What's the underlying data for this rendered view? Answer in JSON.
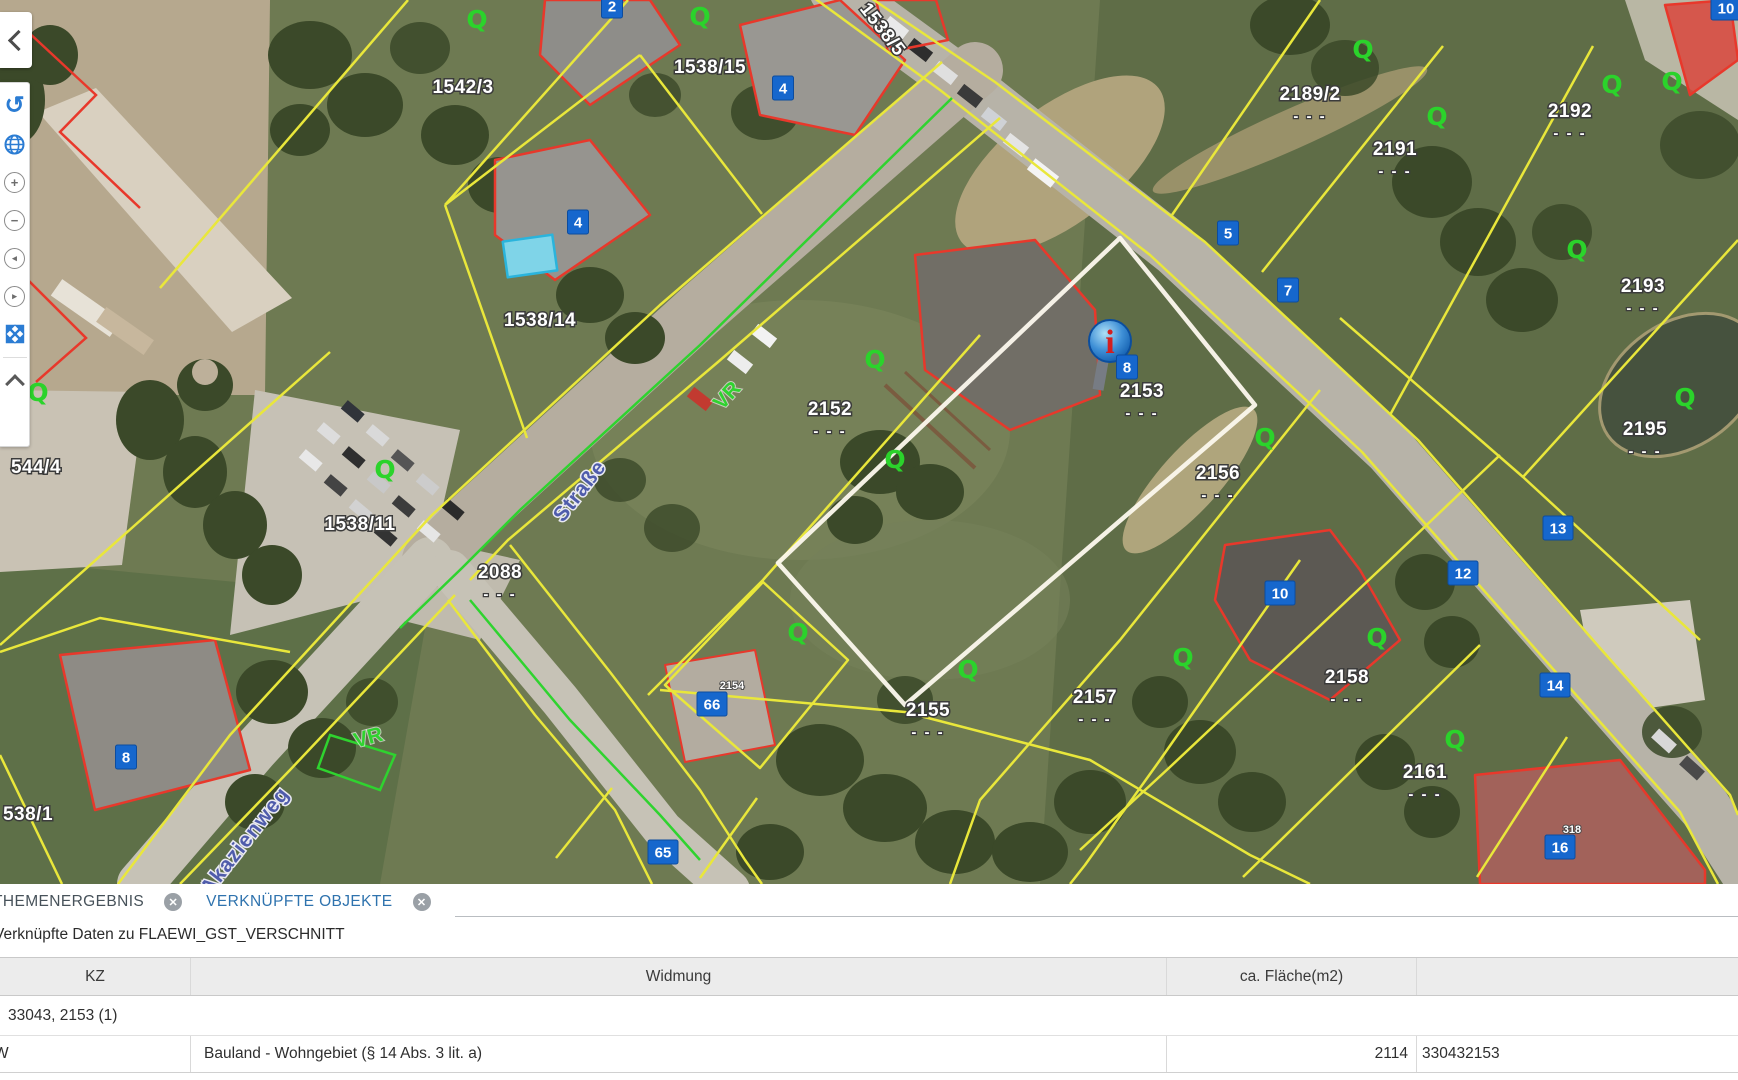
{
  "window": {
    "width": 1738,
    "height": 1080
  },
  "toolbar": {
    "icon_glyphs": {
      "undo": "↺",
      "zoom_in": "+",
      "zoom_out": "−",
      "pan_left": "◂",
      "pan_right": "▸"
    }
  },
  "map": {
    "colors": {
      "parcel_line_yellow": "#e9e73b",
      "building_red": "#e8382b",
      "overlay_green": "#2fd32f",
      "badge_blue": "#1667cd",
      "selection_white": "#fbf7ec",
      "street_blue": "#4f5cab"
    },
    "marker_label": "i",
    "dash_text": "- - -",
    "green_symbol": "Q",
    "parcel_labels": [
      {
        "text": "1542/3",
        "x": 463,
        "y": 93,
        "dashes": false
      },
      {
        "text": "1538/15",
        "x": 710,
        "y": 73,
        "dashes": false
      },
      {
        "text": "1538/5",
        "x": 878,
        "y": 33,
        "dashes": false,
        "rotate": 52
      },
      {
        "text": "1538/14",
        "x": 540,
        "y": 326,
        "dashes": false
      },
      {
        "text": "2189/2",
        "x": 1310,
        "y": 100,
        "dashes": true
      },
      {
        "text": "2191",
        "x": 1395,
        "y": 155,
        "dashes": true
      },
      {
        "text": "2192",
        "x": 1570,
        "y": 117,
        "dashes": true
      },
      {
        "text": "2193",
        "x": 1643,
        "y": 292,
        "dashes": true
      },
      {
        "text": "2195",
        "x": 1645,
        "y": 435,
        "dashes": true
      },
      {
        "text": "2152",
        "x": 830,
        "y": 415,
        "dashes": true
      },
      {
        "text": "2153",
        "x": 1142,
        "y": 397,
        "dashes": true
      },
      {
        "text": "2156",
        "x": 1218,
        "y": 479,
        "dashes": true
      },
      {
        "text": "2088",
        "x": 500,
        "y": 578,
        "dashes": true
      },
      {
        "text": "1538/11",
        "x": 360,
        "y": 530,
        "dashes": false
      },
      {
        "text": "544/4",
        "x": 36,
        "y": 473,
        "dashes": false
      },
      {
        "text": "2155",
        "x": 928,
        "y": 716,
        "dashes": true
      },
      {
        "text": "2157",
        "x": 1095,
        "y": 703,
        "dashes": true
      },
      {
        "text": "2158",
        "x": 1347,
        "y": 683,
        "dashes": true
      },
      {
        "text": "2161",
        "x": 1425,
        "y": 778,
        "dashes": true
      },
      {
        "text": "538/1",
        "x": 28,
        "y": 820,
        "dashes": false
      }
    ],
    "small_labels": [
      {
        "text": "2154",
        "x": 732,
        "y": 689
      },
      {
        "text": "318",
        "x": 1572,
        "y": 833
      }
    ],
    "street_labels": [
      {
        "text": "Straße",
        "x": 585,
        "y": 495,
        "rotate": -52
      },
      {
        "text": "Akazienweg",
        "x": 250,
        "y": 845,
        "rotate": -52
      }
    ],
    "vr_labels": [
      {
        "text": "VR",
        "x": 732,
        "y": 400,
        "rotate": -48
      },
      {
        "text": "VR",
        "x": 370,
        "y": 744,
        "rotate": -15
      }
    ],
    "green_symbols": [
      {
        "x": 477,
        "y": 28
      },
      {
        "x": 700,
        "y": 25
      },
      {
        "x": 1363,
        "y": 58
      },
      {
        "x": 1437,
        "y": 125
      },
      {
        "x": 1612,
        "y": 93
      },
      {
        "x": 1672,
        "y": 90
      },
      {
        "x": 1577,
        "y": 258
      },
      {
        "x": 1685,
        "y": 406
      },
      {
        "x": 875,
        "y": 368
      },
      {
        "x": 895,
        "y": 468
      },
      {
        "x": 798,
        "y": 641
      },
      {
        "x": 968,
        "y": 678
      },
      {
        "x": 38,
        "y": 401
      },
      {
        "x": 385,
        "y": 478
      },
      {
        "x": 1265,
        "y": 446
      },
      {
        "x": 1377,
        "y": 646
      },
      {
        "x": 1455,
        "y": 748
      },
      {
        "x": 1183,
        "y": 666
      }
    ],
    "badges": [
      {
        "text": "2",
        "x": 612,
        "y": 6
      },
      {
        "text": "4",
        "x": 783,
        "y": 88
      },
      {
        "text": "4",
        "x": 578,
        "y": 222
      },
      {
        "text": "5",
        "x": 1228,
        "y": 233
      },
      {
        "text": "7",
        "x": 1288,
        "y": 290
      },
      {
        "text": "8",
        "x": 1127,
        "y": 367
      },
      {
        "text": "10",
        "x": 1280,
        "y": 593
      },
      {
        "text": "13",
        "x": 1558,
        "y": 528
      },
      {
        "text": "12",
        "x": 1463,
        "y": 573
      },
      {
        "text": "14",
        "x": 1555,
        "y": 685
      },
      {
        "text": "16",
        "x": 1560,
        "y": 847
      },
      {
        "text": "66",
        "x": 712,
        "y": 704
      },
      {
        "text": "65",
        "x": 663,
        "y": 852
      },
      {
        "text": "8",
        "x": 126,
        "y": 757
      },
      {
        "text": "10",
        "x": 1726,
        "y": 8
      }
    ]
  },
  "panel": {
    "tabs": [
      {
        "label": "THEMENERGEBNIS"
      },
      {
        "label": "VERKNÜPFTE OBJEKTE"
      }
    ],
    "close_glyph": "✕",
    "subtitle": "Verknüpfte Daten zu FLAEWI_GST_VERSCHNITT",
    "table": {
      "columns": [
        "KZ",
        "Widmung",
        "ca. Fläche(m2)",
        ""
      ],
      "group_row": "33043, 2153 (1)",
      "rows": [
        {
          "kz": "W",
          "widmung": "Bauland - Wohngebiet (§ 14 Abs. 3 lit. a)",
          "flaeche": "2114",
          "extra": "330432153"
        }
      ]
    }
  }
}
